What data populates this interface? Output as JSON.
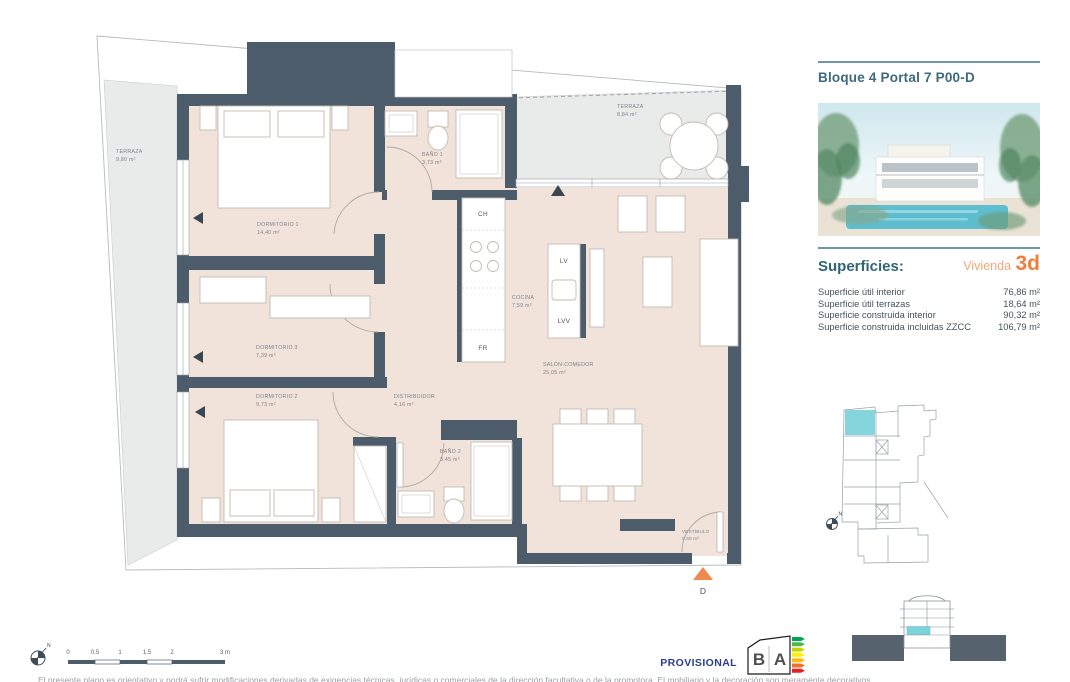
{
  "panel": {
    "title": "Bloque 4 Portal 7 P00-D",
    "superficies_heading": "Superficies:",
    "vivienda_label": "Vivienda",
    "vivienda_value": "3d",
    "rows": [
      {
        "label": "Superficie útil interior",
        "value": "76,86 m²"
      },
      {
        "label": "Superficie útil terrazas",
        "value": "18,64 m²"
      },
      {
        "label": "Superficie construida interior",
        "value": "90,32 m²"
      },
      {
        "label": "Superficie construida incluidas ZZCC",
        "value": "106,79 m²"
      }
    ]
  },
  "plan": {
    "rooms": {
      "terraza_izquierda": {
        "name": "TERRAZA",
        "area": "9,80 m²"
      },
      "terraza_superior": {
        "name": "TERRAZA",
        "area": "8,84 m²"
      },
      "dormitorio1": {
        "name": "DORMITORIO 1",
        "area": "14,40 m²"
      },
      "bano1": {
        "name": "BAÑO 1",
        "area": "3,73 m²"
      },
      "cocina": {
        "name": "COCINA",
        "area": "7,59 m²"
      },
      "salon": {
        "name": "SALÓN-COMEDOR",
        "area": "25,05 m²"
      },
      "dormitorio3": {
        "name": "DORMITORIO 3",
        "area": "7,39 m²"
      },
      "dormitorio2": {
        "name": "DORMITORIO 2",
        "area": "9,73 m²"
      },
      "distribuidor": {
        "name": "DISTRIBUIDOR",
        "area": "4,16 m²"
      },
      "bano2": {
        "name": "BAÑO 2",
        "area": "3,45 m²"
      },
      "vestibulo": {
        "name": "VESTÍBULO",
        "area": "0,80 m²"
      }
    },
    "fixtures": {
      "campana": "CH",
      "lavavajillas": "LV",
      "lavadora": "LVV",
      "frigorifico": "FR"
    },
    "entry_marker": "D",
    "compass_north": "N"
  },
  "scalebar": {
    "ticks": [
      "0",
      "0.5",
      "1",
      "1.5",
      "2",
      "3 m"
    ]
  },
  "footer": {
    "provisional": "PROVISIONAL",
    "energy_label": {
      "letter_left": "B",
      "letter_right": "A",
      "bar_colors": [
        "#00a651",
        "#50b848",
        "#c4d600",
        "#fff200",
        "#fdb913",
        "#f37021",
        "#ed1c24"
      ]
    },
    "disclaimer": "El presente plano es orientativo y podrá sufrir modificaciones derivadas de exigencias técnicas, jurídicas o comerciales de la dirección facultativa o de la promotora. El mobiliario y la decoración son meramente decorativos."
  },
  "colors": {
    "wall": "#4d5c6a",
    "floor": "#f2e3da",
    "terrace": "#e9eaea",
    "accent_teal": "#2d6577",
    "accent_orange": "#ee7f3f",
    "unit_highlight": "#7ed3da"
  }
}
